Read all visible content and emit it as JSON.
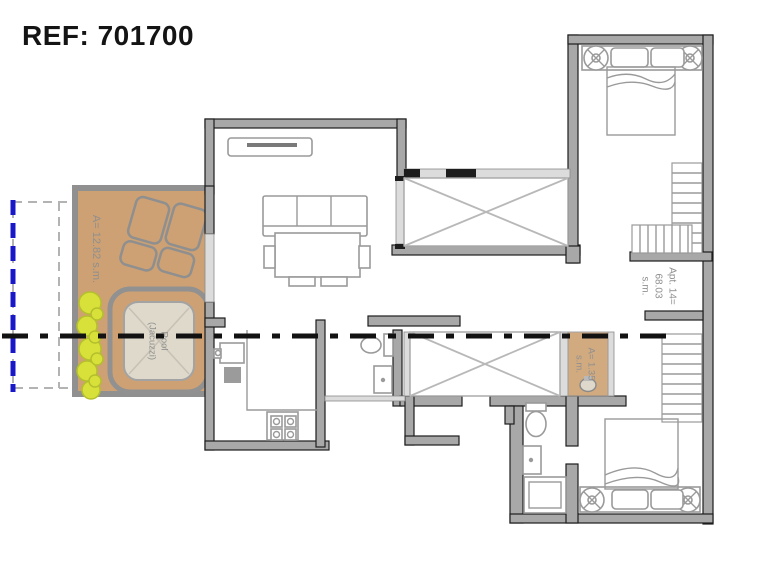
{
  "header": {
    "ref_label": "REF: 701700"
  },
  "labels": {
    "terrace_area": "A= 12.82 s.m.",
    "pool_line1": "Pool",
    "pool_line2": "(Jacuzzi)",
    "apartment_line1": "Apt. 14=",
    "apartment_line2": "68.03",
    "apartment_line3": "s.m.",
    "shaft_line1": "A= 1.35",
    "shaft_line2": "s.m."
  },
  "colors": {
    "terrace_tan": "#cda173",
    "pool_inner": "#ded9cb",
    "plant_green": "#d8e03a",
    "boundary_blue": "#1818c8",
    "wall_gray": "#a8a8a8",
    "wall_edge": "#1d1d1d",
    "window_light": "#dcdcdc",
    "label_gray": "#8f8f8f",
    "section_line": "#121212"
  }
}
